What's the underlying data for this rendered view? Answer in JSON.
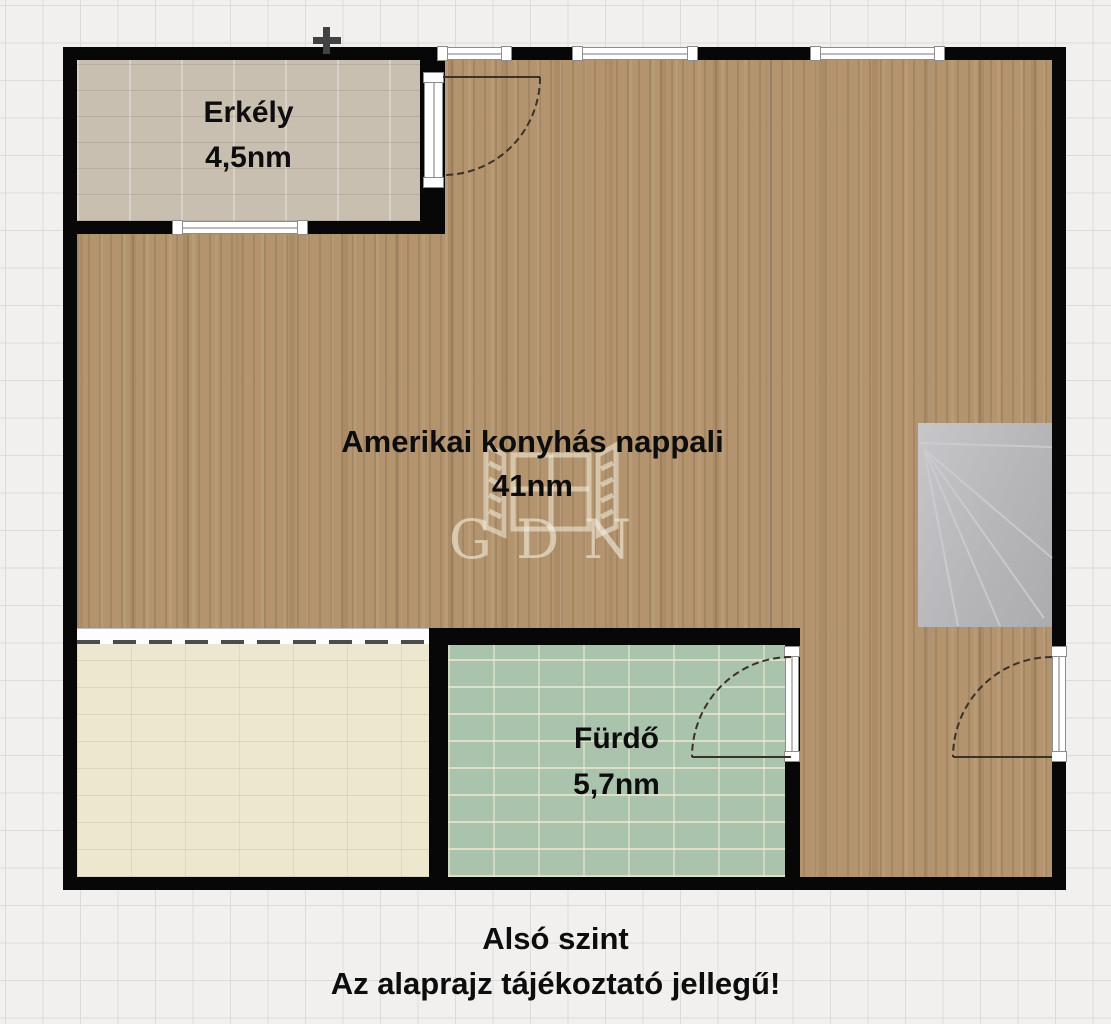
{
  "floorplan": {
    "rooms": {
      "balcony": {
        "name": "Erkély",
        "area": "4,5nm"
      },
      "living": {
        "name": "Amerikai konyhás nappali",
        "area": "41nm"
      },
      "bathroom": {
        "name": "Fürdő",
        "area": "5,7nm"
      }
    },
    "caption": {
      "line1": "Alsó szint",
      "line2": "Az alaprajz tájékoztató jellegű!"
    },
    "watermark": {
      "text": "GDN"
    },
    "colors": {
      "wall": "#070707",
      "wood_floor": "#b3946e",
      "balcony_floor": "#c9bfb0",
      "bathroom_floor": "#aac3ac",
      "bottom_left_room_floor": "#ece7ce",
      "stairs": "#bcbcbe",
      "window": "#ffffff",
      "background": "#f1f0ee"
    }
  }
}
